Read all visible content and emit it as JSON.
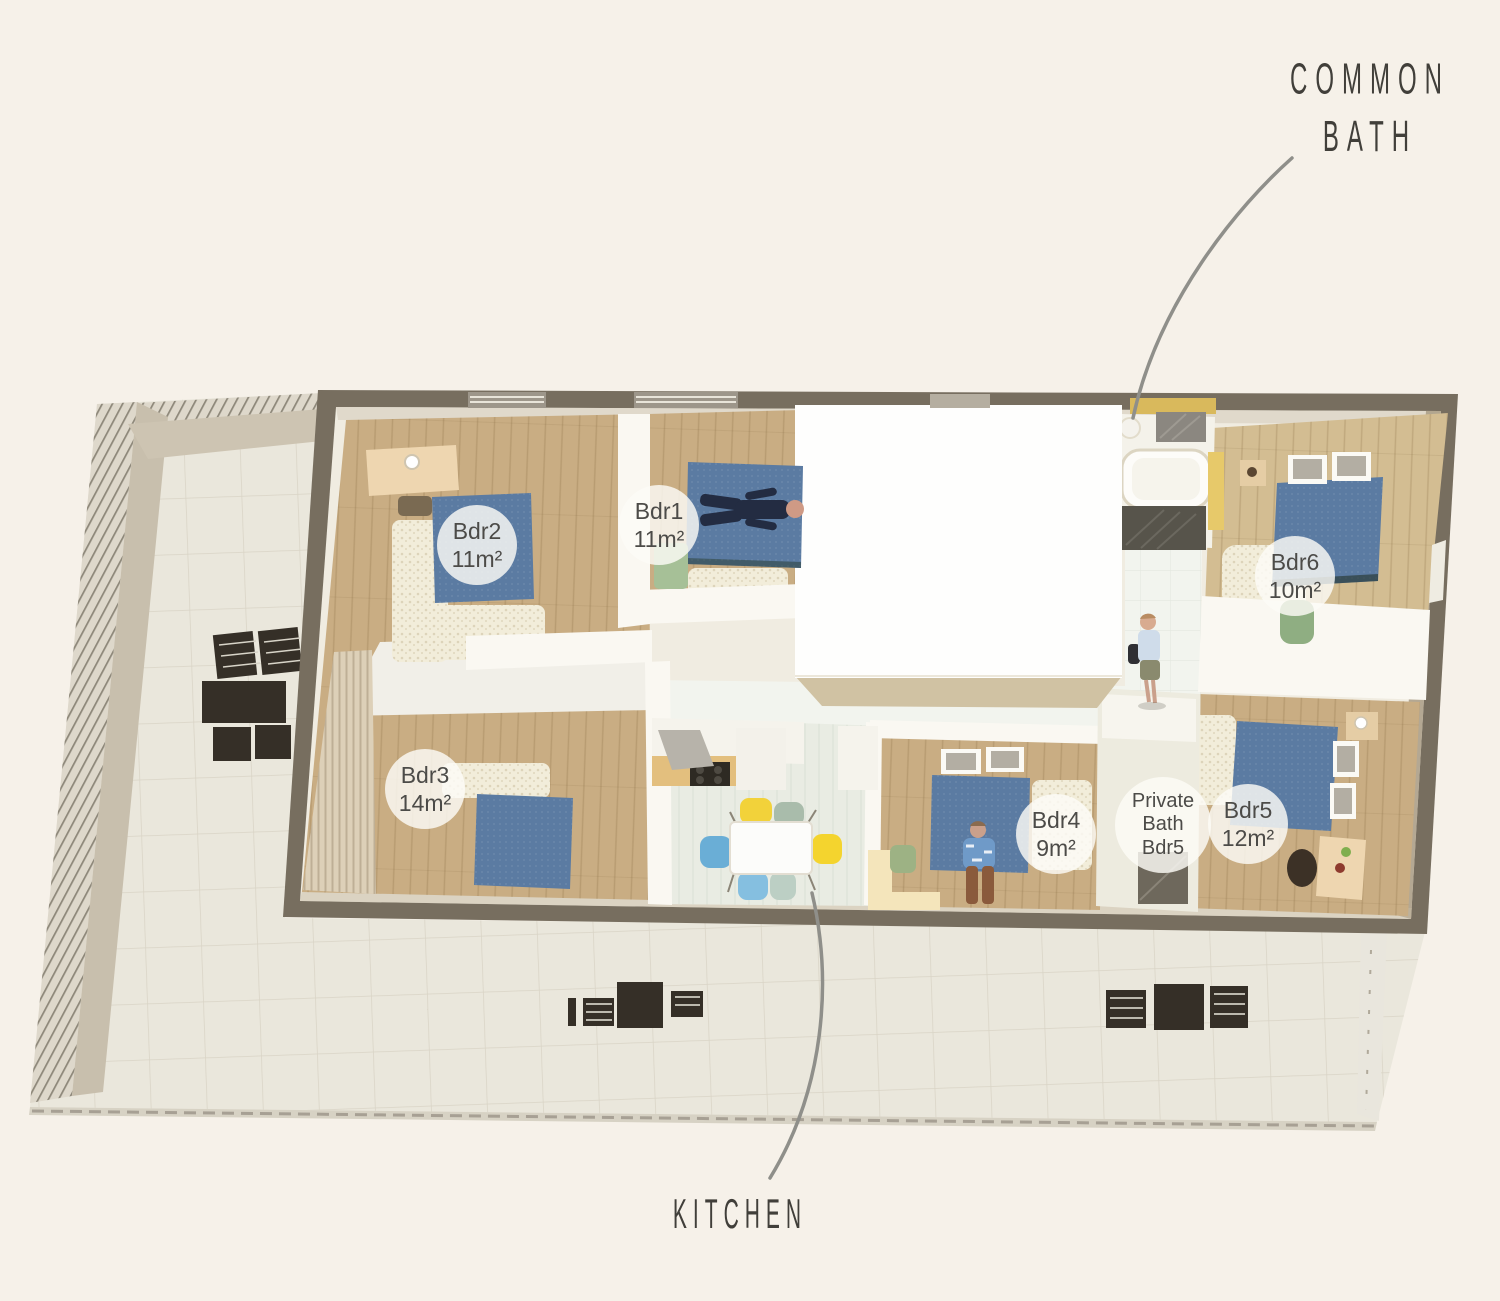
{
  "scene": {
    "type": "3d-floorplan-top-view"
  },
  "annotations": {
    "common_bath": {
      "line1": "COMMON",
      "line2": "BATH"
    },
    "kitchen": {
      "label": "KITCHEN"
    }
  },
  "room_badges": {
    "bdr1": {
      "name": "Bdr1",
      "area": "11m²"
    },
    "bdr2": {
      "name": "Bdr2",
      "area": "11m²"
    },
    "bdr3": {
      "name": "Bdr3",
      "area": "14m²"
    },
    "bdr4": {
      "name": "Bdr4",
      "area": "9m²"
    },
    "bdr5": {
      "name": "Bdr5",
      "area": "12m²"
    },
    "bdr6": {
      "name": "Bdr6",
      "area": "10m²"
    },
    "private_bath": {
      "line1": "Private",
      "line2": "Bath",
      "line3": "Bdr5"
    }
  },
  "colors": {
    "page_bg": "#f6f1e9",
    "wall_dark": "#776e5f",
    "interior": "#f0ece1",
    "wood": "#c9ad83",
    "wood_light": "#d3bd92",
    "bed_blue": "#5b7ba2",
    "terrace_tile": "#eae7dc",
    "leader_line": "#8f8f8a",
    "label_text": "#4c4b48",
    "badge_bg": "rgba(252,251,246,0.82)",
    "accent_yellow": "#e7c96a",
    "accent_green": "#9db984",
    "dark_furniture": "#352f27"
  }
}
